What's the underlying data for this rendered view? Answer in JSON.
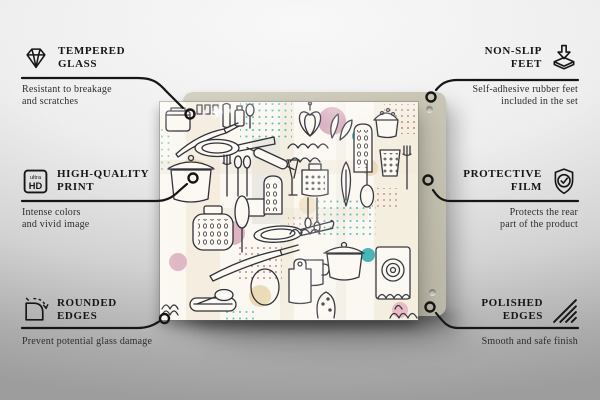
{
  "callouts": [
    {
      "id": "tempered-glass",
      "icon": "diamond-icon",
      "title_lines": [
        "TEMPERED",
        "GLASS"
      ],
      "description_lines": [
        "Resistant to breakage",
        "and scratches"
      ]
    },
    {
      "id": "high-quality-print",
      "icon": "ultra-hd-icon",
      "icon_text": [
        "ultra",
        "HD"
      ],
      "title_lines": [
        "HIGH-QUALITY",
        "PRINT"
      ],
      "description_lines": [
        "Intense colors",
        "and vivid image"
      ]
    },
    {
      "id": "rounded-edges",
      "icon": "rounded-corner-arrow-icon",
      "title_lines": [
        "ROUNDED",
        "EDGES"
      ],
      "description_lines": [
        "Prevent potential glass damage"
      ]
    },
    {
      "id": "non-slip-feet",
      "icon": "rubber-foot-arrow-icon",
      "title_lines": [
        "NON-SLIP",
        "FEET"
      ],
      "description_lines": [
        "Self-adhesive rubber feet",
        "included in the set"
      ]
    },
    {
      "id": "protective-film",
      "icon": "shield-check-icon",
      "title_lines": [
        "PROTECTIVE",
        "FILM"
      ],
      "description_lines": [
        "Protects the rear",
        "part of the product"
      ]
    },
    {
      "id": "polished-edges",
      "icon": "hatched-edges-icon",
      "title_lines": [
        "POLISHED",
        "EDGES"
      ],
      "description_lines": [
        "Smooth and safe finish"
      ]
    }
  ],
  "product": {
    "pattern_theme": "kitchen utensils doodle pattern"
  },
  "colors": {
    "connector": "#161616",
    "title_text": "#161616",
    "description_text": "#2d2d2d",
    "backing_panel": "#c8c5b4",
    "glass_background": "#fbf8f1",
    "doodle_stroke": "#30303a",
    "accent_teal": "#3fb3b5",
    "accent_pink": "#d2a0b4",
    "accent_beige": "#ecdcb6",
    "accent_dot_maroon": "#b2636c"
  }
}
